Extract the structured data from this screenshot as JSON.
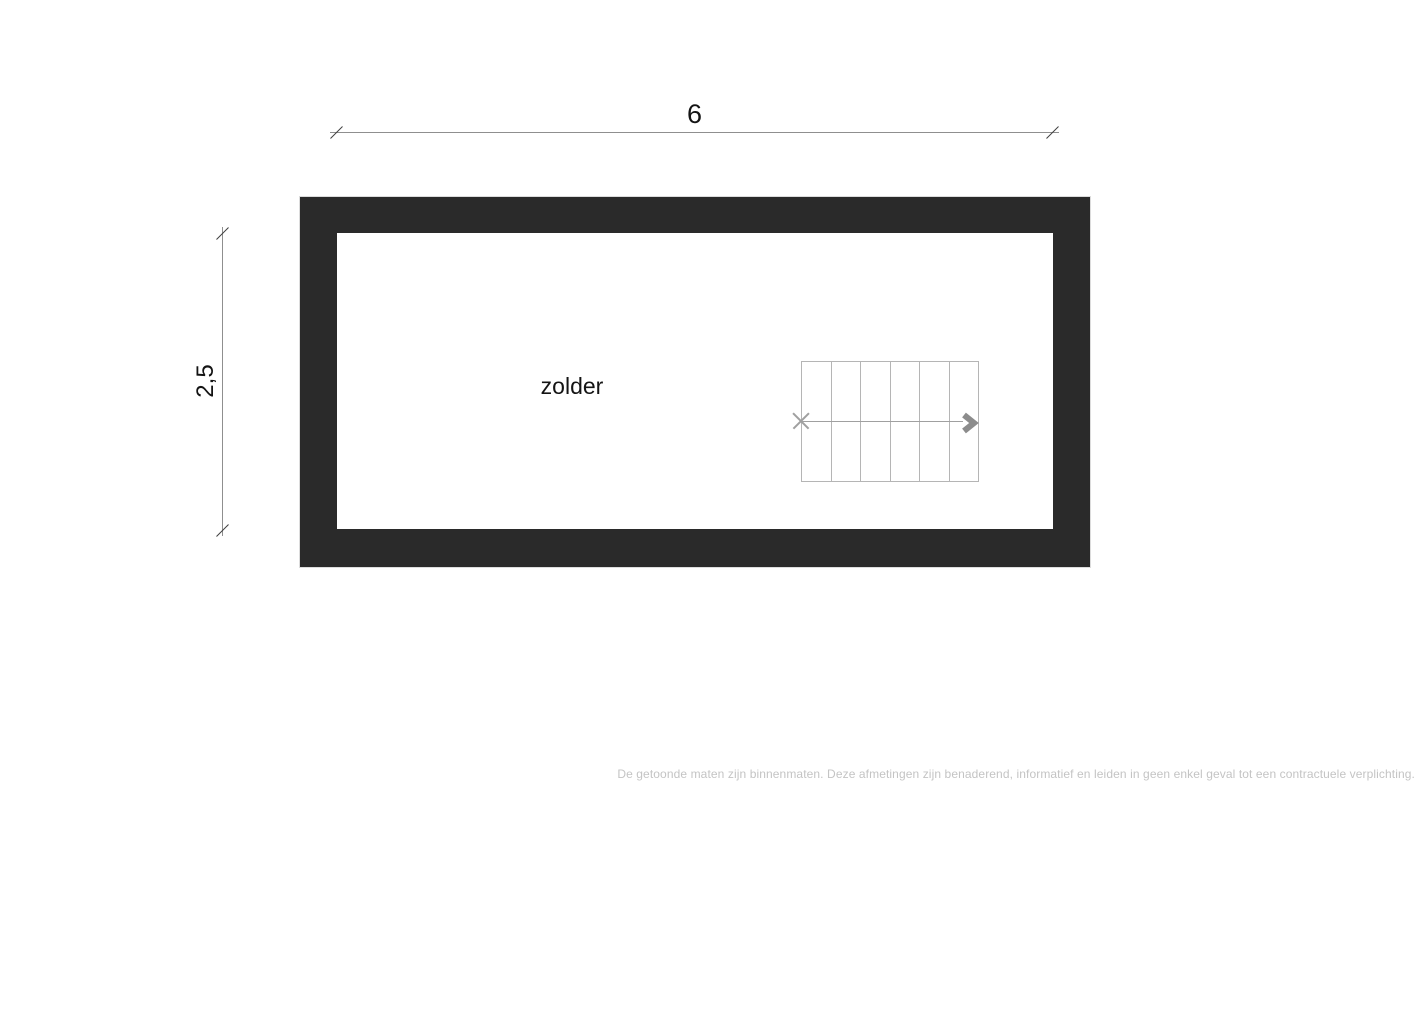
{
  "floorplan": {
    "room": {
      "label": "zolder"
    },
    "dimensions": {
      "width": {
        "label": "6"
      },
      "height": {
        "label": "2,5"
      }
    },
    "stairs": {
      "step_count": 6,
      "direction_icon": "chevron-right",
      "start_icon": "x-cross"
    },
    "colors": {
      "wall": "#2a2a2a",
      "dimension_line": "#8f8f8f",
      "tick": "#3f3f3f",
      "stair_line": "#b5b5b5",
      "walk_line": "#a0a0a0",
      "arrow": "#8c8c8c",
      "label": "#141414",
      "disclaimer": "#c4c4c4"
    }
  },
  "footer": {
    "disclaimer": "De getoonde maten zijn binnenmaten. Deze afmetingen zijn benaderend, informatief en leiden in geen enkel geval tot een contractuele verplichting."
  }
}
